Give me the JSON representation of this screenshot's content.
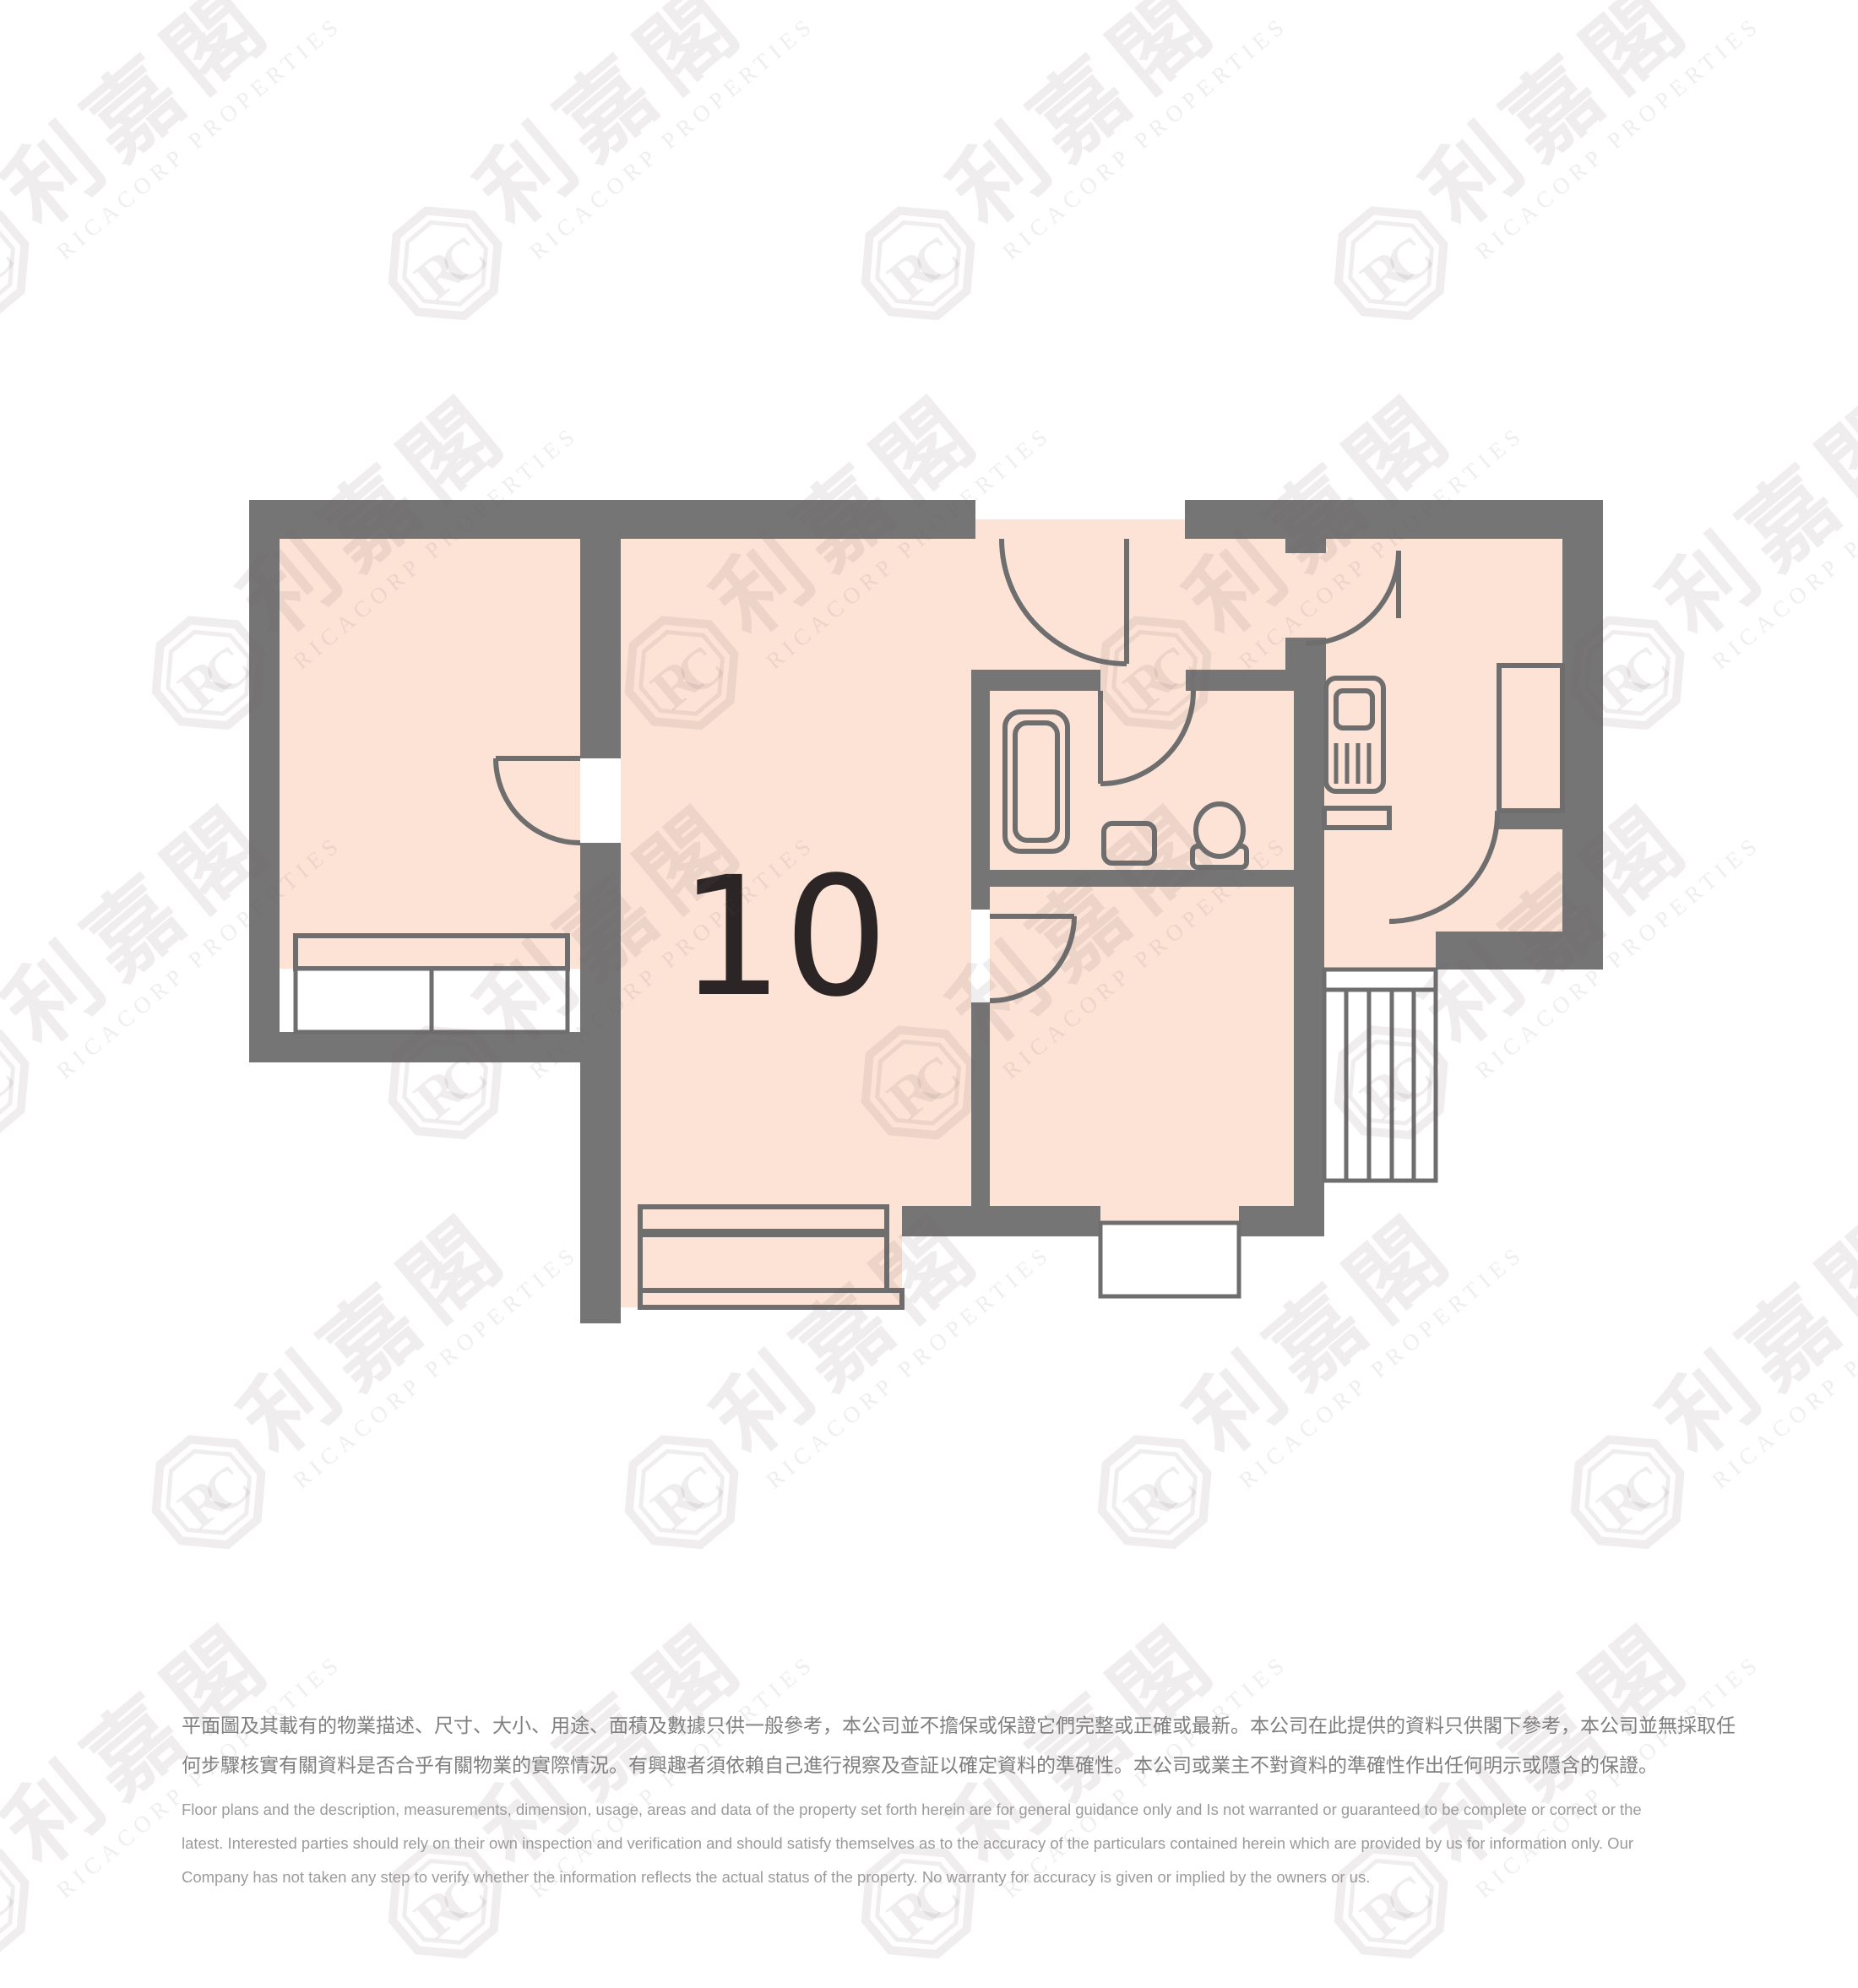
{
  "floorplan": {
    "unit_label": "10"
  },
  "watermark": {
    "logo_text": "RC",
    "cn_text": "利嘉閣",
    "en_text": "RICACORP PROPERTIES"
  },
  "disclaimer": {
    "chinese_lines": [
      "平面圖及其載有的物業描述、尺寸、大小、用途、面積及數據只供一般參考，本公司並不擔保或保證它們完整或正確或最新。本公司在此提供的資料只供閣下參考，本公司並無採取任",
      "何步驟核實有關資料是否合乎有關物業的實際情況。有興趣者須依賴自己進行視察及查証以確定資料的準確性。本公司或業主不對資料的準確性作出任何明示或隱含的保證。"
    ],
    "english_lines": [
      "Floor plans and the description, measurements, dimension, usage, areas and data of the property set forth herein are for general guidance only and Is not warranted or guaranteed to be complete or correct or the",
      "latest. Interested parties should rely on their own inspection and verification and should satisfy themselves as to the accuracy of the particulars contained herein which are provided by us for information only.  Our",
      "Company has not taken any step to verify whether the information reflects the actual status of the property.  No warranty for accuracy is given or implied by the owners or us."
    ]
  },
  "colors": {
    "wall": "#757575",
    "room_fill": "#fce3d6",
    "line": "#6e6e6e",
    "label": "#2b2526",
    "background": "#ffffff"
  }
}
